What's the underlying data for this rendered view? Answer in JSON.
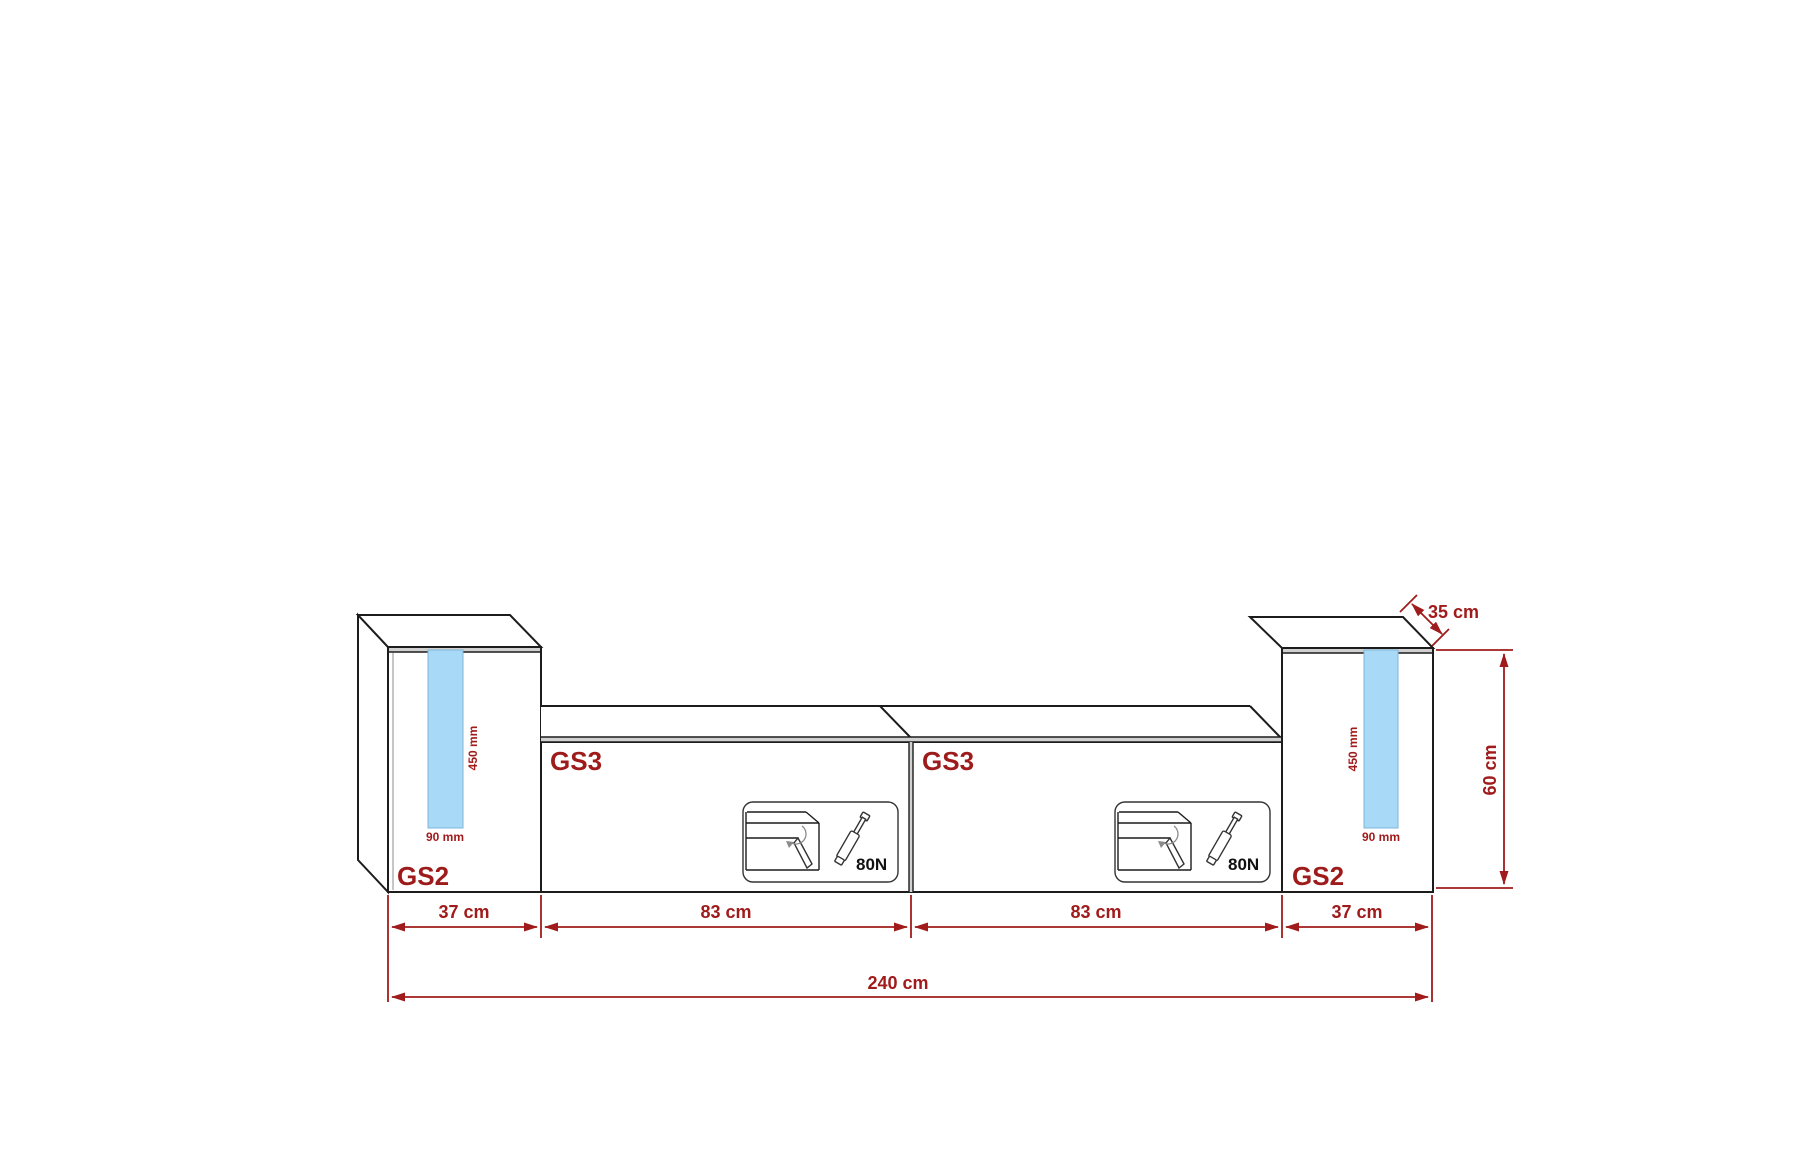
{
  "diagram_title": "wall-unit-dimension-drawing",
  "colors": {
    "dimension_red": "#A01B1B",
    "led_blue": "#A8D9F6",
    "outline_dark": "#1c1c1c",
    "background": "#ffffff"
  },
  "cabinets": {
    "left_tall": {
      "label": "GS2",
      "led": {
        "length": "450 mm",
        "width": "90 mm"
      }
    },
    "left_wide": {
      "label": "GS3",
      "gas_lift": "80N"
    },
    "right_wide": {
      "label": "GS3",
      "gas_lift": "80N"
    },
    "right_tall": {
      "label": "GS2",
      "led": {
        "length": "450 mm",
        "width": "90 mm"
      }
    }
  },
  "dimensions": {
    "segments": [
      "37 cm",
      "83 cm",
      "83 cm",
      "37 cm"
    ],
    "total_width": "240 cm",
    "height": "60 cm",
    "depth": "35 cm"
  }
}
